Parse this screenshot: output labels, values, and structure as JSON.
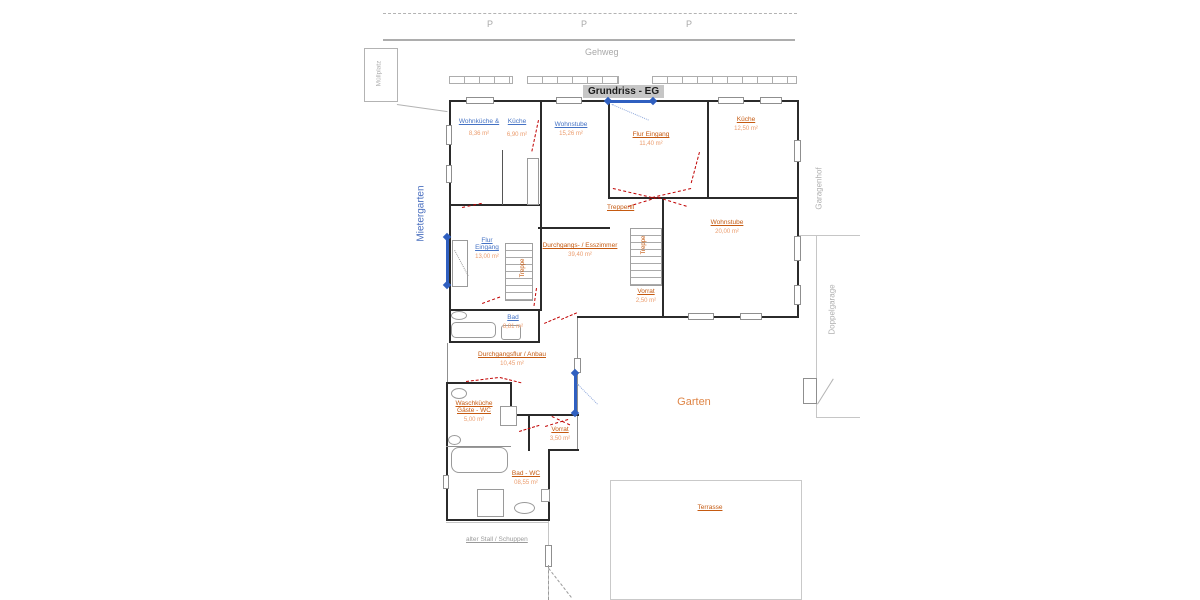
{
  "title": "Grundriss - EG",
  "site": {
    "parking": [
      "P",
      "P",
      "P"
    ],
    "gehweg": "Gehweg",
    "muellplatz": "Müllplatz",
    "mietergarten": "Mietergarten",
    "garagenhof": "Garagenhof",
    "doppelgarage": "Doppelgarage",
    "garten": "Garten",
    "terrasse": "Terrasse",
    "alter_stall": "alter Stall / Schuppen"
  },
  "rooms": {
    "wohnkueche": {
      "label": "Wohnküche &",
      "area": "8,36 m²"
    },
    "kueche_klein": {
      "label": "Küche",
      "area": "6,90 m²"
    },
    "wohnstube_top": {
      "label": "Wohnstube",
      "area": "15,26 m²"
    },
    "flur_top": {
      "label": "Flur Eingang",
      "area": "11,40 m²"
    },
    "kueche_rechts": {
      "label": "Küche",
      "area": "12,50 m²"
    },
    "flur_links": {
      "label_line1": "Flur",
      "label_line2": "Eingang",
      "area": "13,00 m²"
    },
    "treppe_links": {
      "label": "Treppe"
    },
    "treppenfl": {
      "label": "Treppenfl"
    },
    "esszimmer": {
      "label": "Durchgangs- / Esszimmer",
      "area": "39,40 m²"
    },
    "treppe_rechts": {
      "label": "Treppe"
    },
    "wohnstube_re": {
      "label": "Wohnstube",
      "area": "20,00 m²"
    },
    "vorrat_mitte": {
      "label": "Vorrat",
      "area": "2,50 m²"
    },
    "bad": {
      "label": "Bad",
      "area": "8,81 m²"
    },
    "anbau": {
      "label": "Durchgangsflur / Anbau",
      "area": "10,45 m²"
    },
    "waschkueche": {
      "label_line1": "Waschküche",
      "label_line2": "Gäste - WC",
      "area": "5,00 m²"
    },
    "vorrat_unten": {
      "label": "Vorrat",
      "area": "3,50 m²"
    },
    "bad_wc": {
      "label": "Bad - WC",
      "area": "08,55 m²"
    }
  },
  "colors": {
    "unit_a_label": "#4472c4",
    "unit_b_label": "#c55a11",
    "area_value": "#eb9c6d",
    "garten_label": "#df8546",
    "wall": "#2b2b2b",
    "door_marker": "#c00000",
    "dimension_line": "#2f5fc0",
    "site_gray": "#adadad",
    "title_bg": "#c6c6c6"
  }
}
